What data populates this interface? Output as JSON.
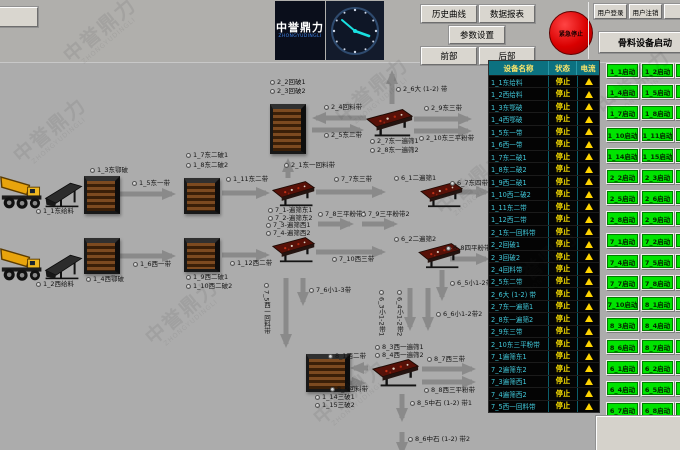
{
  "watermark": {
    "text": "中誉鼎力",
    "subtext": "ZHONGYUDINGLI"
  },
  "topbar": {
    "corner_button_label": "",
    "logo": {
      "title": "中誉鼎力",
      "subtitle": "ZHONGYUDINGLI"
    },
    "history_button": "历史曲线",
    "report_button": "数据报表",
    "params_button": "参数设置",
    "front_button": "前部",
    "rear_button": "后部",
    "emergency_button": "紧急停止",
    "user_login_button": "用户登录",
    "user_logout_button": "用户注销",
    "extra_user_button": "",
    "aggregate_start_button": "骨料设备启动"
  },
  "diagram": {
    "labels": [
      {
        "text": "1_1东给料",
        "x": 36,
        "y": 208
      },
      {
        "text": "1_3东鄂破",
        "x": 90,
        "y": 167
      },
      {
        "text": "1_5东一带",
        "x": 132,
        "y": 180
      },
      {
        "text": "1_7东二破1",
        "x": 186,
        "y": 152
      },
      {
        "text": "1_8东二破2",
        "x": 186,
        "y": 162
      },
      {
        "text": "1_11东二带",
        "x": 226,
        "y": 176
      },
      {
        "text": "7_1-遍筛东1",
        "x": 268,
        "y": 207
      },
      {
        "text": "7_2-遍筛东2",
        "x": 268,
        "y": 215
      },
      {
        "text": "7_7东三带",
        "x": 334,
        "y": 176
      },
      {
        "text": "6_1二遍筛1",
        "x": 394,
        "y": 175
      },
      {
        "text": "6_7东四带",
        "x": 450,
        "y": 180
      },
      {
        "text": "1_2西给料",
        "x": 36,
        "y": 281
      },
      {
        "text": "1_4西鄂破",
        "x": 86,
        "y": 276
      },
      {
        "text": "1_6西一带",
        "x": 133,
        "y": 261
      },
      {
        "text": "1_9西二破1",
        "x": 186,
        "y": 274
      },
      {
        "text": "1_10西二破2",
        "x": 186,
        "y": 283
      },
      {
        "text": "1_12西二带",
        "x": 230,
        "y": 260
      },
      {
        "text": "7_3-遍筛西1",
        "x": 266,
        "y": 222
      },
      {
        "text": "7_4-遍筛西2",
        "x": 266,
        "y": 230
      },
      {
        "text": "7_10西三带",
        "x": 332,
        "y": 256
      },
      {
        "text": "6_2二遍筛2",
        "x": 394,
        "y": 236
      },
      {
        "text": "6_8四平粉带",
        "x": 446,
        "y": 245
      },
      {
        "text": "2_1东一回料带",
        "x": 284,
        "y": 162
      },
      {
        "text": "2_2回破1",
        "x": 270,
        "y": 79
      },
      {
        "text": "2_3回破2",
        "x": 270,
        "y": 88
      },
      {
        "text": "2_4回料带",
        "x": 324,
        "y": 104
      },
      {
        "text": "2_5东二带",
        "x": 324,
        "y": 132
      },
      {
        "text": "2_6大 (1-2) 带",
        "x": 396,
        "y": 86
      },
      {
        "text": "2_7东一遍筛1",
        "x": 370,
        "y": 138
      },
      {
        "text": "2_8东一遍筛2",
        "x": 370,
        "y": 147
      },
      {
        "text": "2_9东三带",
        "x": 424,
        "y": 105
      },
      {
        "text": "2_10东三平粉带",
        "x": 419,
        "y": 135
      },
      {
        "text": "7_8三平粉带1",
        "x": 318,
        "y": 211
      },
      {
        "text": "7_9三平粉带2",
        "x": 361,
        "y": 211
      },
      {
        "text": "7_5西一回料带",
        "x": 263,
        "y": 283,
        "rot": 1
      },
      {
        "text": "7_6小1-3带",
        "x": 309,
        "y": 287
      },
      {
        "text": "6_5小1-2带1",
        "x": 450,
        "y": 280
      },
      {
        "text": "6_3小1-2带1",
        "x": 378,
        "y": 290,
        "rot": 1
      },
      {
        "text": "6_4小1-2带2",
        "x": 396,
        "y": 290,
        "rot": 1
      },
      {
        "text": "6_6小1-2带2",
        "x": 436,
        "y": 311
      },
      {
        "text": "8_3西一遍筛1",
        "x": 375,
        "y": 344
      },
      {
        "text": "8_4西一遍筛2",
        "x": 375,
        "y": 352
      },
      {
        "text": "8_1西二带",
        "x": 328,
        "y": 353
      },
      {
        "text": "8_2回料带",
        "x": 330,
        "y": 386
      },
      {
        "text": "1_14三破1",
        "x": 315,
        "y": 394
      },
      {
        "text": "1_15三破2",
        "x": 315,
        "y": 402
      },
      {
        "text": "8_7西三带",
        "x": 427,
        "y": 356
      },
      {
        "text": "8_8西三平粉带",
        "x": 424,
        "y": 387
      },
      {
        "text": "8_5中石 (1-2) 带1",
        "x": 410,
        "y": 400
      },
      {
        "text": "8_6中石 (1-2) 带2",
        "x": 408,
        "y": 436
      }
    ]
  },
  "table": {
    "headers": [
      "设备名称",
      "状态",
      "电流"
    ],
    "status_value": "停止",
    "rows": [
      "1_1东给料",
      "1_2西给料",
      "1_3东鄂破",
      "1_4西鄂破",
      "1_5东一带",
      "1_6西一带",
      "1_7东二破1",
      "1_8东二破2",
      "1_9西二破1",
      "1_10西二破2",
      "1_11东二带",
      "1_12西二带",
      "2_1东一回料带",
      "2_2回破1",
      "2_3回破2",
      "2_4回料带",
      "2_5东二带",
      "2_6大 (1-2) 带",
      "2_7东一遍筛1",
      "2_8东一遍筛2",
      "2_9东三带",
      "2_10东三平粉带",
      "7_1遍筛东1",
      "7_2遍筛东2",
      "7_3遍筛西1",
      "7_4遍筛西2",
      "7_5西一回料带"
    ]
  },
  "start_buttons": {
    "rows": [
      [
        "1_1启动",
        "1_2启动",
        ""
      ],
      [
        "1_4启动",
        "1_5启动",
        ""
      ],
      [
        "1_7启动",
        "1_8启动",
        ""
      ],
      [
        "1_10启动",
        "1_11启动",
        ""
      ],
      [
        "1_14启动",
        "1_15启动",
        ""
      ],
      [
        "2_2启动",
        "2_3启动",
        ""
      ],
      [
        "2_5启动",
        "2_6启动",
        ""
      ],
      [
        "2_8启动",
        "2_9启动",
        ""
      ],
      [
        "7_1启动",
        "7_2启动",
        ""
      ],
      [
        "7_4启动",
        "7_5启动",
        ""
      ],
      [
        "7_7启动",
        "7_8启动",
        ""
      ],
      [
        "7_10启动",
        "8_1启动",
        ""
      ],
      [
        "8_3启动",
        "8_4启动",
        ""
      ],
      [
        "8_6启动",
        "8_7启动",
        ""
      ],
      [
        "6_1启动",
        "6_2启动",
        ""
      ],
      [
        "6_4启动",
        "6_5启动",
        ""
      ],
      [
        "6_7启动",
        "6_8启动",
        ""
      ]
    ]
  },
  "colors": {
    "background_gray": "#acacac",
    "start_green": "#00e400",
    "status_yellow": "#ffe400",
    "alarm_icon_yellow": "#ffd400",
    "emergency_red": "#d90000",
    "table_header_teal": "#0c7180",
    "device_name_cyan": "#41c8da",
    "logo_blue": "#3f83e8"
  }
}
